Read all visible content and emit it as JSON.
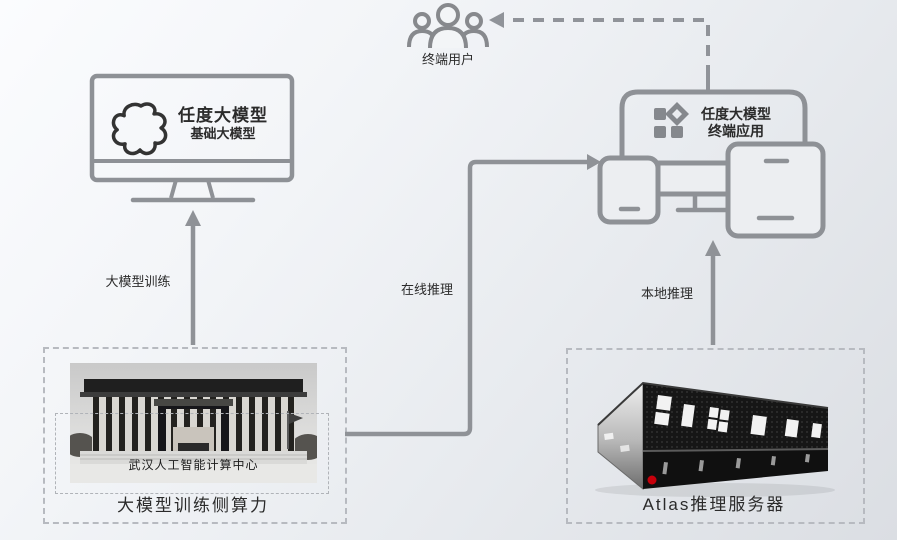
{
  "colors": {
    "line": "#8f9297",
    "text": "#2b2b2b",
    "dashed_box_border": "#b7bac0",
    "huawei_red": "#c7000b"
  },
  "nodes": {
    "end_user": {
      "label": "终端用户",
      "icon": "users-icon"
    },
    "base_model": {
      "title": "任度大模型",
      "subtitle": "基础大模型",
      "icon": "blob-logo-icon"
    },
    "terminal_app": {
      "title": "任度大模型",
      "subtitle": "终端应用",
      "icon": "app-grid-icon"
    },
    "training_power": {
      "label": "大模型训练侧算力",
      "photo_caption": "武汉人工智能计算中心"
    },
    "atlas_server": {
      "label": "Atlas推理服务器"
    }
  },
  "edges": {
    "training": {
      "label": "大模型训练"
    },
    "online_inference": {
      "label": "在线推理"
    },
    "local_inference": {
      "label": "本地推理"
    }
  }
}
